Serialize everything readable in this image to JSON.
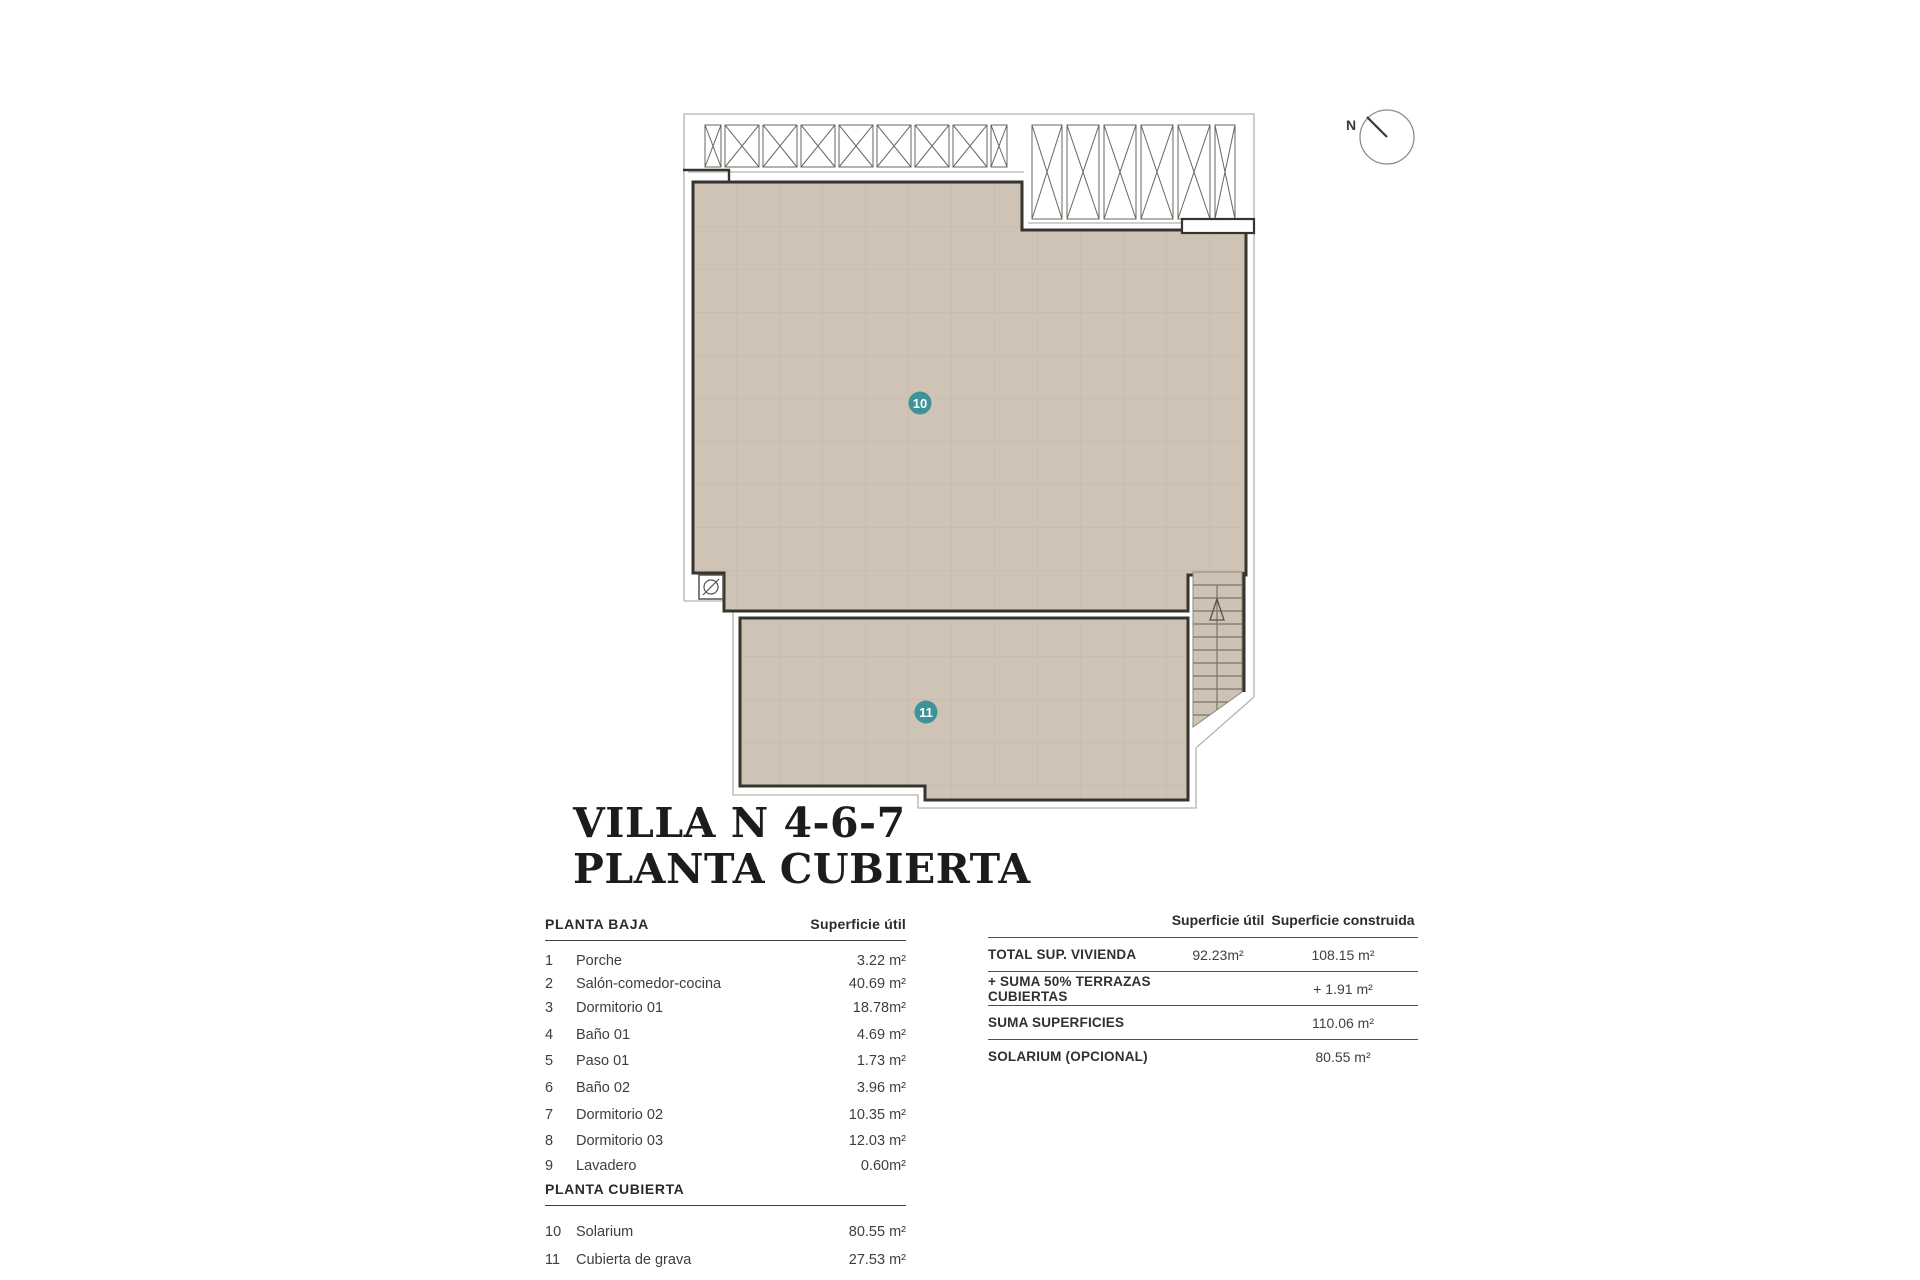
{
  "title": {
    "line1": "VILLA N 4-6-7",
    "line2": "PLANTA CUBIERTA"
  },
  "plan": {
    "badges": [
      {
        "label": "10"
      },
      {
        "label": "11"
      }
    ],
    "compass_label": "N",
    "colors": {
      "roof_fill": "#cec3b4",
      "roof_grid": "#c2b7a7",
      "wall": "#35342f",
      "thin_line": "#b4b2ac",
      "badge": "#3e939b",
      "badge_text": "#ffffff"
    }
  },
  "left_table": {
    "section1_title": "PLANTA BAJA",
    "col_header": "Superficie útil",
    "rows_baja": [
      {
        "num": "1",
        "label": "Porche",
        "value": "3.22 m²"
      },
      {
        "num": "2",
        "label": "Salón-comedor-cocina",
        "value": "40.69 m²"
      },
      {
        "num": "3",
        "label": "Dormitorio 01",
        "value": "18.78m²"
      },
      {
        "num": "4",
        "label": "Baño 01",
        "value": "4.69 m²"
      },
      {
        "num": "5",
        "label": "Paso 01",
        "value": "1.73 m²"
      },
      {
        "num": "6",
        "label": "Baño 02",
        "value": "3.96 m²"
      },
      {
        "num": "7",
        "label": "Dormitorio 02",
        "value": "10.35 m²"
      },
      {
        "num": "8",
        "label": "Dormitorio 03",
        "value": "12.03 m²"
      },
      {
        "num": "9",
        "label": "Lavadero",
        "value": "0.60m²"
      }
    ],
    "section2_title": "PLANTA CUBIERTA",
    "rows_cubierta": [
      {
        "num": "10",
        "label": "Solarium",
        "value": "80.55 m²"
      },
      {
        "num": "11",
        "label": "Cubierta de grava",
        "value": "27.53 m²"
      }
    ]
  },
  "right_table": {
    "col1_header": "Superficie útil",
    "col2_header": "Superficie construida",
    "rows": [
      {
        "label": "TOTAL SUP. VIVIENDA",
        "util": "92.23m²",
        "construida": "108.15 m²"
      },
      {
        "label": "+ SUMA 50% TERRAZAS CUBIERTAS",
        "util": "",
        "construida": "+ 1.91 m²"
      },
      {
        "label": "SUMA SUPERFICIES",
        "util": "",
        "construida": "110.06 m²"
      },
      {
        "label": "SOLARIUM (OPCIONAL)",
        "util": "",
        "construida": "80.55 m²"
      }
    ]
  }
}
